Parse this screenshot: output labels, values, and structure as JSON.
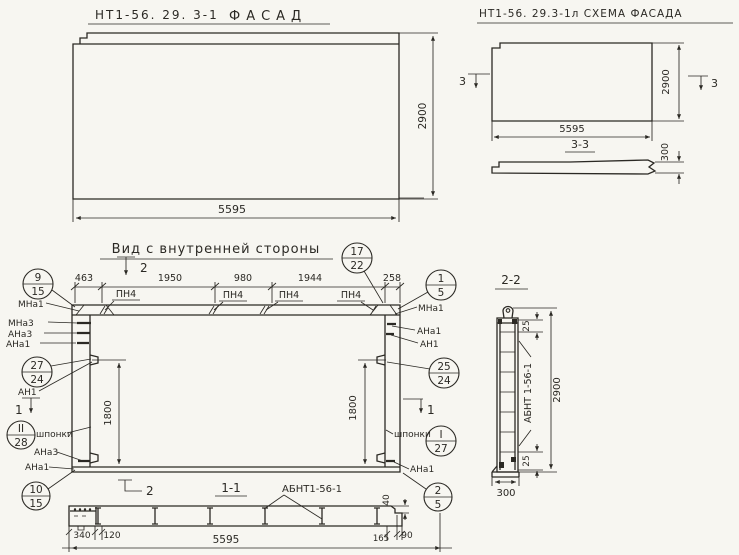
{
  "drawing": {
    "paper_color": "#f7f6f1",
    "ink_color": "#2b2924"
  },
  "facade_view": {
    "title_code": "НТ1-56. 29. 3-1",
    "title_name": "ФАСАД",
    "dim_height": "2900",
    "dim_width": "5595"
  },
  "schema_view": {
    "title": "НТ1-56. 29.3-1л СХЕМА ФАСАДА",
    "marker_left": "3",
    "marker_right": "3",
    "dim_height": "2900",
    "dim_width": "5595",
    "section_title": "3-3",
    "dim_thickness": "300"
  },
  "inner_view": {
    "title": "Вид с внутренней стороны",
    "dims_top": [
      "463",
      "1950",
      "980",
      "1944",
      "258"
    ],
    "marker_top": "2",
    "marker_bottom": "2",
    "marker_left": "1",
    "marker_right": "1",
    "plate_label": "ПН4",
    "dim_left": "1800",
    "dim_right": "1800",
    "shponki_left": "шпонки",
    "shponki_right": "шпонки",
    "callouts": {
      "c17_22": {
        "top": "17",
        "bottom": "22"
      },
      "c9_15": {
        "top": "9",
        "bottom": "15"
      },
      "c27_24": {
        "top": "27",
        "bottom": "24"
      },
      "c2_28": {
        "top": "II",
        "bottom": "28"
      },
      "c10_15": {
        "top": "10",
        "bottom": "15"
      },
      "c1_5": {
        "top": "1",
        "bottom": "5"
      },
      "c25_24": {
        "top": "25",
        "bottom": "24"
      },
      "c1_27": {
        "top": "I",
        "bottom": "27"
      },
      "c2_5": {
        "top": "2",
        "bottom": "5"
      }
    },
    "labels_left": {
      "mna1": "МНа1",
      "mna3": "МНа3",
      "ana3": "АНа3",
      "ana1": "АНа1",
      "an1": "АН1",
      "ana3_low": "АНа3",
      "ana1_low": "АНа1"
    },
    "labels_right": {
      "mna1": "МНа1",
      "ana1": "АНа1",
      "an1": "АН1",
      "ana1_low": "АНа1"
    }
  },
  "section_1_1": {
    "title": "1-1",
    "part_label": "АБНТ1-56-1",
    "dim_340": "340",
    "dim_120": "120",
    "dim_165": "165",
    "dim_90": "90",
    "dim_40": "40",
    "dim_width": "5595"
  },
  "section_2_2": {
    "title": "2-2",
    "part_label": "АБНТ 1-56-1",
    "dim_25_top": "25",
    "dim_25_bottom": "25",
    "dim_height": "2900",
    "dim_width": "300"
  }
}
